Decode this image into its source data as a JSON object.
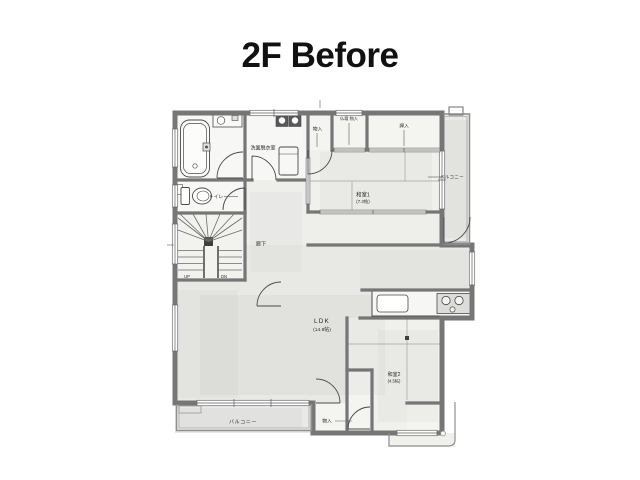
{
  "page": {
    "title": "2F Before"
  },
  "floorplan": {
    "rooms": {
      "washroom": {
        "label": "洗面脱衣室"
      },
      "toilet": {
        "label": "トイレ"
      },
      "corridor": {
        "label": "廊下"
      },
      "storage_top": {
        "label": "物入"
      },
      "altar_storage": {
        "label": "仏壇 物入"
      },
      "oshiire": {
        "label": "押入"
      },
      "washitsu1": {
        "name": "和室1",
        "size": "(7.3帖)"
      },
      "balcony_right": {
        "label": "バルコニー"
      },
      "ldk": {
        "name": "LDK",
        "size": "(14.8帖)"
      },
      "washitsu2": {
        "name": "和室2",
        "size": "(4.5帖)"
      },
      "storage_bottom": {
        "label": "物入"
      },
      "balcony_bottom": {
        "label": "バルコニー"
      },
      "stairs": {
        "up": "UP",
        "dn": "DN"
      }
    },
    "colors": {
      "wall": "#767676",
      "line": "#4a4a4a",
      "wash_fill": "#e8e8e5",
      "paper": "#ffffff",
      "text": "#2b2b2b"
    }
  }
}
